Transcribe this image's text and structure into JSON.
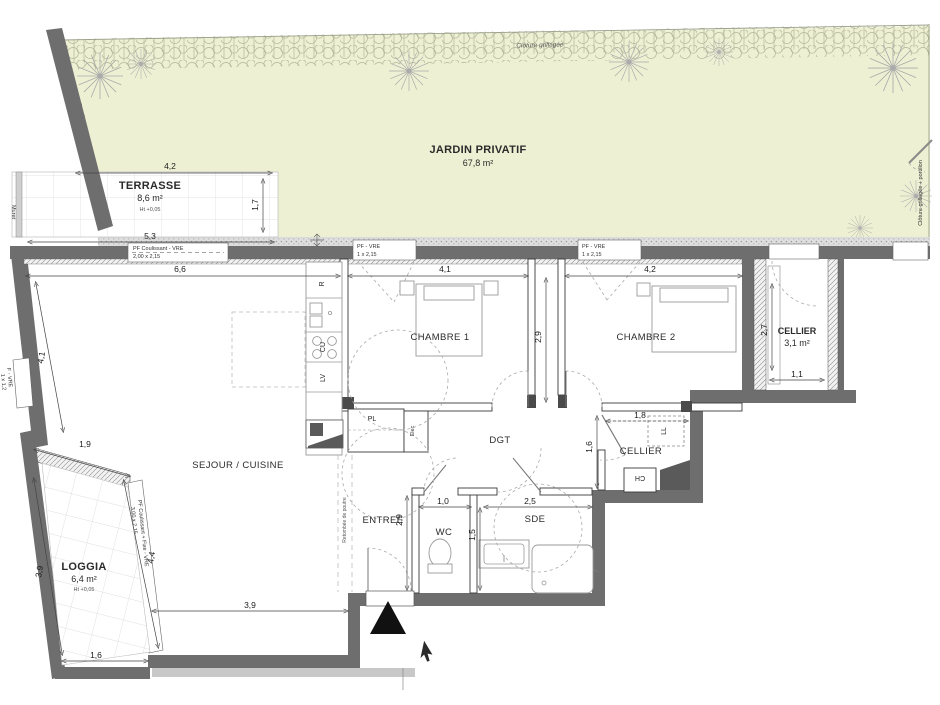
{
  "garden": {
    "label": "JARDIN PRIVATIF",
    "area": "67,8 m²",
    "fence_top": "Clôture grillagée",
    "fence_right": "Clôture grillagée + portillon",
    "stairs": "Escalier",
    "low_wall": "Muret"
  },
  "terrace": {
    "label": "TERRASSE",
    "area": "8,6 m²",
    "height_note": "Ht +0,05",
    "dim_top": "4,2",
    "dim_right": "1,7",
    "dim_bottom": "5,3"
  },
  "loggia": {
    "label": "LOGGIA",
    "area": "6,4 m²",
    "height_note": "Ht +0,05",
    "dim_top": "1,9",
    "dim_left": "3,9",
    "dim_right": "4,4",
    "dim_bottom": "1,6"
  },
  "rooms": {
    "sejour": {
      "label": "SEJOUR / CUISINE",
      "dim_top": "6,6",
      "dim_bottom": "3,9",
      "dim_left_wall": "4,1"
    },
    "chambre1": {
      "label": "CHAMBRE 1",
      "dim_width": "4,1"
    },
    "chambre2": {
      "label": "CHAMBRE 2",
      "dim_width": "4,2"
    },
    "couloir": {
      "dim": "2,9"
    },
    "dgt": {
      "label": "DGT"
    },
    "entree": {
      "label": "ENTREE",
      "dim_height": "2,9"
    },
    "wc": {
      "label": "WC",
      "dim_width": "1,0",
      "dim_right": "1,5"
    },
    "sde": {
      "label": "SDE",
      "dim_width": "2,5"
    },
    "cellier_int": {
      "label": "CELLIER",
      "dim_width": "1,8",
      "dim_left": "1,6"
    },
    "cellier_ext": {
      "label": "CELLIER",
      "area": "3,1 m²",
      "dim_height": "2,7",
      "dim_width": "1,1"
    },
    "placard": {
      "label": "PL"
    }
  },
  "openings": {
    "terrace_door": {
      "line1": "PF Coulissant - VRE",
      "line2": "2,00 x 2,15"
    },
    "chambre1_window": {
      "line1": "PF - VRE",
      "line2": "1 x 2,15"
    },
    "chambre2_window": {
      "line1": "PF - VRE",
      "line2": "1 x 2,15"
    },
    "sejour_window": {
      "line1": "F - VRE",
      "line2": "1 x 1,2"
    },
    "loggia_window": {
      "line1": "PF Coulissant + Fixe - VRE",
      "line2": "3,00 x 2,15"
    }
  },
  "equipment": {
    "elec": "Elec",
    "fridge": "R",
    "hob": "CU",
    "dishwasher": "LV",
    "washer": "LL",
    "boiler": "CH",
    "beam_note": "Retombée de poutre"
  },
  "colors": {
    "garden": "#eef0d3",
    "wall": "#6e6e6e"
  }
}
